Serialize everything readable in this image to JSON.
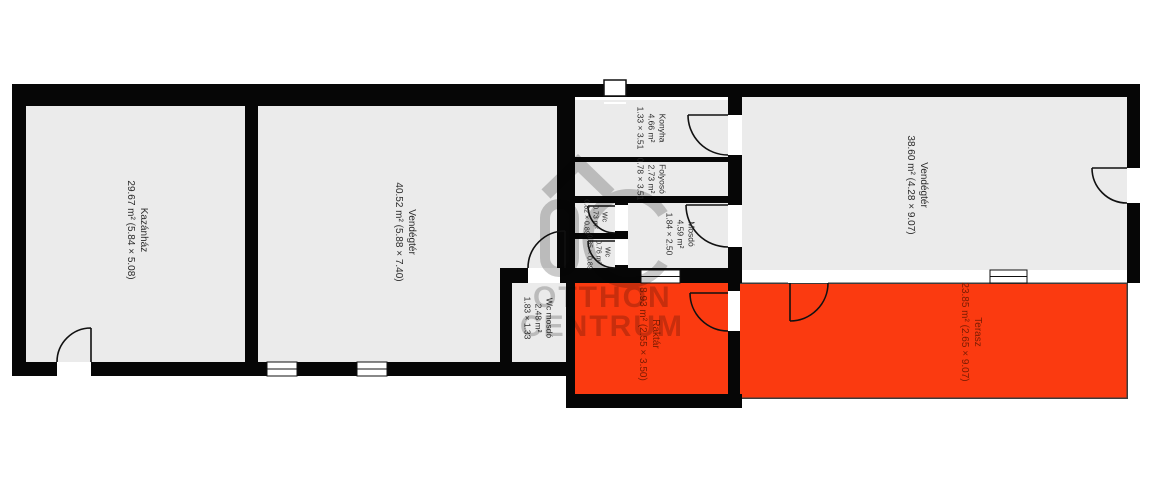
{
  "plan_title": "floor-plan",
  "colors": {
    "wall": "#060606",
    "room_fill": "#ebebeb",
    "terrace_fill": "#fb3a10",
    "terrace_label": "#7a1c03",
    "label": "#2b2b2b",
    "watermark": "#c4c4c4"
  },
  "watermark": {
    "monogram": "OC",
    "line1": "OTTHON",
    "line2": "CENTRUM"
  },
  "rooms": [
    {
      "key": "kazanhaz",
      "name": "Kazánház",
      "line2": "29.67 m² (5.84 × 5.08)"
    },
    {
      "key": "vendegter_left",
      "name": "Vendégtér",
      "line2": "40.52 m² (5.88 × 7.40)"
    },
    {
      "key": "konyha",
      "name": "Konyha",
      "line2": "4.66 m²",
      "line3": "1.33 × 3.51"
    },
    {
      "key": "folyoso",
      "name": "Folyosó",
      "line2": "2.73 m²",
      "line3": "0.78 × 3.51"
    },
    {
      "key": "wc_1",
      "name": "Wc",
      "line2": "0.73 m²",
      "line3": "0.82 × 0.89"
    },
    {
      "key": "wc_2",
      "name": "Wc",
      "line2": "0.76 m²",
      "line3": "0.85 × 0.89"
    },
    {
      "key": "mosdo",
      "name": "Mosdó",
      "line2": "4.59 m²",
      "line3": "1.84 × 2.50"
    },
    {
      "key": "wc_mosdo",
      "name": "Wc mosdó",
      "line2": "2.48 m²",
      "line3": "1.83 × 1.33"
    },
    {
      "key": "raktar",
      "name": "Raktár",
      "line2": "8.93 m² (2.55 × 3.50)"
    },
    {
      "key": "terasz",
      "name": "Terasz",
      "line2": "23.85 m² (2.65 × 9.07)"
    },
    {
      "key": "vendegter_right",
      "name": "Vendégtér",
      "line2": "38.60 m² (4.28 × 9.07)"
    }
  ]
}
